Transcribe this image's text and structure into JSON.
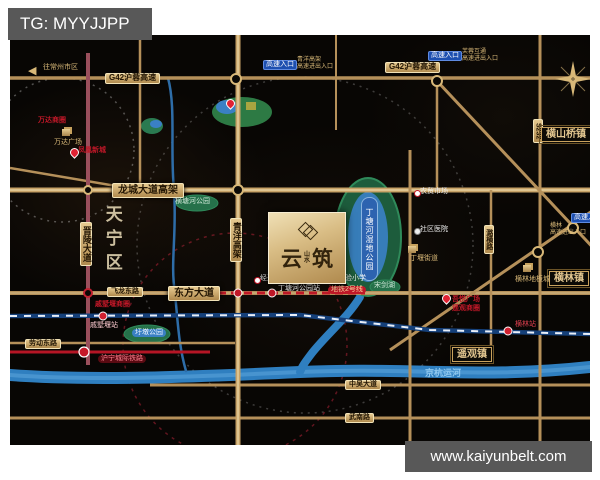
{
  "palette": {
    "gold": "#c9a25e",
    "road": "#b5905a",
    "metro_red": "#c01828",
    "river": "#2f7fc0",
    "park": "#1d5c3c",
    "badge_blue": "#1d4fb0",
    "box_gray": "#585858",
    "map_bg": "#080604"
  },
  "overlay": {
    "tg_label": "TG: MYYJJPP",
    "website": "www.kaiyunbelt.com"
  },
  "map": {
    "project": {
      "name_main_left": "云",
      "name_main_right": "筑",
      "name_small": "山\n水"
    },
    "park_main_label": "丁塘河湿地公园",
    "district": {
      "t": "天宁区",
      "x": 92,
      "y": 170
    },
    "west_arrow": {
      "glyph": "◀",
      "x": 18,
      "y": 31
    },
    "road_labels": [
      {
        "t": "G42沪蓉高速",
        "x": 95,
        "y": 38,
        "fs": 8
      },
      {
        "t": "G42沪蓉高速",
        "x": 375,
        "y": 27,
        "fs": 8
      },
      {
        "t": "龙城大道高架",
        "x": 102,
        "y": 148,
        "fs": 10,
        "big": 1
      },
      {
        "t": "东方大道",
        "x": 158,
        "y": 251,
        "fs": 10,
        "big": 1
      },
      {
        "t": "飞龙东路",
        "x": 97,
        "y": 252,
        "fs": 7
      },
      {
        "t": "劳动东路",
        "x": 15,
        "y": 304,
        "fs": 7
      },
      {
        "t": "中吴大道",
        "x": 335,
        "y": 345,
        "fs": 7
      },
      {
        "t": "武南路",
        "x": 335,
        "y": 378,
        "fs": 7
      },
      {
        "t": "晋陵大道",
        "x": 70,
        "y": 187,
        "fs": 9,
        "vert": 1
      },
      {
        "t": "青洋高架",
        "x": 220,
        "y": 183,
        "fs": 9,
        "vert": 1
      },
      {
        "t": "潞横路",
        "x": 474,
        "y": 190,
        "fs": 7,
        "vert": 1
      },
      {
        "t": "S232",
        "x": 523,
        "y": 84,
        "fs": 7,
        "vert": 1
      }
    ],
    "towns": [
      {
        "t": "横山桥镇",
        "x": 531,
        "y": 92
      },
      {
        "t": "横林镇",
        "x": 539,
        "y": 236
      },
      {
        "t": "遥观镇",
        "x": 442,
        "y": 312
      }
    ],
    "badges": [
      {
        "t": "高速入口",
        "x": 253,
        "y": 25,
        "sub": "青洋高架\n高速进出入口",
        "sx": 287,
        "sy": 22
      },
      {
        "t": "高速入口",
        "x": 418,
        "y": 16,
        "sub": "芙蓉互通\n高速进出入口",
        "sx": 452,
        "sy": 14
      },
      {
        "t": "高速入口",
        "x": 561,
        "y": 178,
        "sub": "横林\n高速进出入口",
        "sx": 540,
        "sy": 188
      }
    ],
    "commercial": [
      {
        "t": "万达商圈",
        "x": 28,
        "y": 82
      },
      {
        "t": "戚墅堰商圈",
        "x": 85,
        "y": 266
      },
      {
        "t": "吾悦广场",
        "x": 442,
        "y": 261
      },
      {
        "t": "遥观商圈",
        "x": 442,
        "y": 270
      },
      {
        "t": "凤凰新城",
        "x": 68,
        "y": 112
      }
    ],
    "pois": [
      {
        "t": "往常州市区",
        "x": 33,
        "y": 29,
        "c": "#d8b878",
        "fs": 7
      },
      {
        "t": "万达广场",
        "x": 44,
        "y": 104,
        "c": "#d8b878",
        "fs": 7
      },
      {
        "t": "横塘河公园",
        "x": 165,
        "y": 163,
        "c": "#cfe8d8",
        "fs": 7
      },
      {
        "t": "圩墩公园",
        "x": 122,
        "y": 294,
        "c": "#eaf4ff",
        "fs": 7,
        "bg": "#3a80c4",
        "pill": 1
      },
      {
        "t": "宋剑湖",
        "x": 364,
        "y": 247,
        "c": "#cfe8d8",
        "fs": 7
      },
      {
        "t": "京杭运河",
        "x": 415,
        "y": 334,
        "c": "#8fc8ef",
        "fs": 9,
        "bold": 1
      },
      {
        "t": "经开区实验中学",
        "x": 250,
        "y": 240,
        "c": "#f0f0f0",
        "fs": 7
      },
      {
        "t": "经开区实验小学",
        "x": 307,
        "y": 240,
        "c": "#f0f0f0",
        "fs": 7
      },
      {
        "t": "丁塘河公园站",
        "x": 268,
        "y": 250,
        "c": "#ffffff",
        "fs": 7
      },
      {
        "t": "地铁2号线",
        "x": 318,
        "y": 251,
        "c": "#ffd9a0",
        "fs": 7,
        "bg": "#c01828",
        "pill": 1
      },
      {
        "t": "戚墅堰站",
        "x": 80,
        "y": 287,
        "c": "#ffccd2",
        "fs": 7
      },
      {
        "t": "横林站",
        "x": 505,
        "y": 286,
        "c": "#e04050",
        "fs": 7
      },
      {
        "t": "沪宁城际铁路",
        "x": 88,
        "y": 320,
        "c": "#ff8090",
        "fs": 7,
        "bg": "#5a0a12",
        "pill": 1
      },
      {
        "t": "农贸市场",
        "x": 410,
        "y": 153,
        "c": "#f0f0f0",
        "fs": 7
      },
      {
        "t": "社区医院",
        "x": 410,
        "y": 191,
        "c": "#f0f0f0",
        "fs": 7
      },
      {
        "t": "丁堰街道",
        "x": 400,
        "y": 220,
        "c": "#d8b878",
        "fs": 7
      },
      {
        "t": "横林地板城",
        "x": 505,
        "y": 241,
        "c": "#d8b878",
        "fs": 7
      }
    ],
    "markers": [
      {
        "k": "pin",
        "x": 60,
        "y": 113
      },
      {
        "k": "pin",
        "x": 216,
        "y": 64
      },
      {
        "k": "pin",
        "x": 432,
        "y": 259
      },
      {
        "k": "bld",
        "x": 52,
        "y": 94
      },
      {
        "k": "bld",
        "x": 398,
        "y": 211
      },
      {
        "k": "bld",
        "x": 513,
        "y": 230
      },
      {
        "k": "dot",
        "x": 244,
        "y": 242
      },
      {
        "k": "dot",
        "x": 301,
        "y": 242
      },
      {
        "k": "dot",
        "x": 404,
        "y": 155
      },
      {
        "k": "dotw",
        "x": 404,
        "y": 193
      }
    ]
  }
}
